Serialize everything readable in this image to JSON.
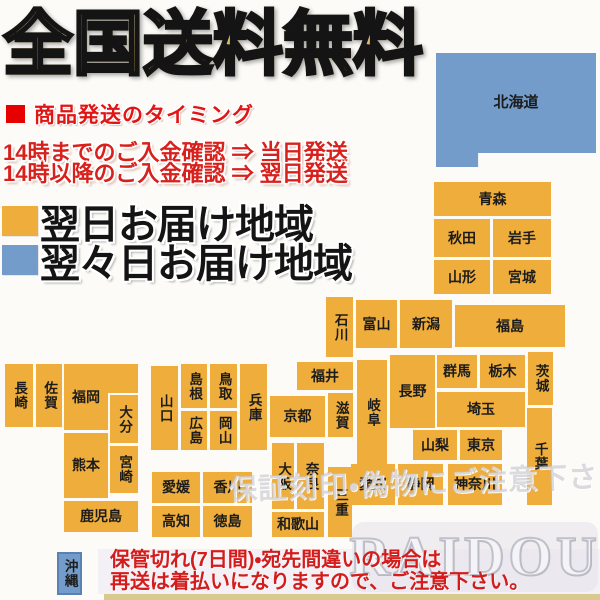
{
  "header": {
    "title": "全国送料無料",
    "shipping_heading": "商品発送のタイミング",
    "timing_lines": [
      "14時までのご入金確認 ⇒ 当日発送",
      "14時以降のご入金確認 ⇒ 翌日発送"
    ],
    "legend": [
      {
        "label": "翌日お届け地域",
        "zone": "next_day"
      },
      {
        "label": "翌々日お届け地域",
        "zone": "two_day"
      }
    ]
  },
  "colors": {
    "next_day": "#efae3b",
    "two_day": "#739cca",
    "accent_red": "#d8201c",
    "title_gold": "#d2a94e",
    "notice_bg": "#f3f1f6",
    "bottom_strip": "#d8c98f"
  },
  "map": {
    "blocks": [
      {
        "id": "hokkaido",
        "label": "北海道",
        "x": 436,
        "y": 53,
        "w": 160,
        "h": 114,
        "zone": "two_day",
        "dir": "h",
        "shape": "hokkaido"
      },
      {
        "id": "aomori",
        "label": "青森",
        "x": 434,
        "y": 182,
        "w": 117,
        "h": 34,
        "zone": "next_day",
        "dir": "h"
      },
      {
        "id": "akita",
        "label": "秋田",
        "x": 434,
        "y": 219,
        "w": 56,
        "h": 38,
        "zone": "next_day",
        "dir": "h"
      },
      {
        "id": "iwate",
        "label": "岩手",
        "x": 493,
        "y": 219,
        "w": 58,
        "h": 38,
        "zone": "next_day",
        "dir": "h"
      },
      {
        "id": "yamagata",
        "label": "山形",
        "x": 434,
        "y": 260,
        "w": 56,
        "h": 34,
        "zone": "next_day",
        "dir": "h"
      },
      {
        "id": "miyagi",
        "label": "宮城",
        "x": 493,
        "y": 260,
        "w": 58,
        "h": 34,
        "zone": "next_day",
        "dir": "h"
      },
      {
        "id": "fukushima",
        "label": "福島",
        "x": 455,
        "y": 305,
        "w": 110,
        "h": 42,
        "zone": "next_day",
        "dir": "h"
      },
      {
        "id": "niigata",
        "label": "新潟",
        "x": 400,
        "y": 300,
        "w": 52,
        "h": 48,
        "zone": "next_day",
        "dir": "h"
      },
      {
        "id": "toyama",
        "label": "富山",
        "x": 356,
        "y": 300,
        "w": 41,
        "h": 48,
        "zone": "next_day",
        "dir": "h"
      },
      {
        "id": "ishikawa",
        "label": "石川",
        "x": 326,
        "y": 297,
        "w": 27,
        "h": 60,
        "zone": "next_day",
        "dir": "v"
      },
      {
        "id": "fukui",
        "label": "福井",
        "x": 297,
        "y": 362,
        "w": 56,
        "h": 28,
        "zone": "next_day",
        "dir": "h"
      },
      {
        "id": "gifu",
        "label": "岐阜",
        "x": 357,
        "y": 360,
        "w": 30,
        "h": 105,
        "zone": "next_day",
        "dir": "v"
      },
      {
        "id": "nagano",
        "label": "長野",
        "x": 390,
        "y": 355,
        "w": 45,
        "h": 73,
        "zone": "next_day",
        "dir": "h"
      },
      {
        "id": "gunma",
        "label": "群馬",
        "x": 437,
        "y": 355,
        "w": 40,
        "h": 33,
        "zone": "next_day",
        "dir": "h"
      },
      {
        "id": "tochigi",
        "label": "栃木",
        "x": 480,
        "y": 355,
        "w": 45,
        "h": 33,
        "zone": "next_day",
        "dir": "h"
      },
      {
        "id": "ibaraki",
        "label": "茨城",
        "x": 528,
        "y": 352,
        "w": 25,
        "h": 53,
        "zone": "next_day",
        "dir": "v"
      },
      {
        "id": "saitama",
        "label": "埼玉",
        "x": 437,
        "y": 392,
        "w": 88,
        "h": 35,
        "zone": "next_day",
        "dir": "h"
      },
      {
        "id": "yamanashi",
        "label": "山梨",
        "x": 413,
        "y": 430,
        "w": 44,
        "h": 30,
        "zone": "next_day",
        "dir": "h"
      },
      {
        "id": "tokyo",
        "label": "東京",
        "x": 460,
        "y": 430,
        "w": 42,
        "h": 30,
        "zone": "next_day",
        "dir": "h"
      },
      {
        "id": "chiba",
        "label": "千葉",
        "x": 527,
        "y": 408,
        "w": 25,
        "h": 97,
        "zone": "next_day",
        "dir": "v"
      },
      {
        "id": "kanagawa",
        "label": "神奈川",
        "x": 448,
        "y": 464,
        "w": 54,
        "h": 41,
        "zone": "next_day",
        "dir": "h"
      },
      {
        "id": "shizuoka",
        "label": "静岡",
        "x": 398,
        "y": 464,
        "w": 45,
        "h": 41,
        "zone": "next_day",
        "dir": "h"
      },
      {
        "id": "aichi",
        "label": "愛知",
        "x": 351,
        "y": 464,
        "w": 44,
        "h": 41,
        "zone": "next_day",
        "dir": "h"
      },
      {
        "id": "kyoto",
        "label": "京都",
        "x": 270,
        "y": 396,
        "w": 55,
        "h": 41,
        "zone": "next_day",
        "dir": "h"
      },
      {
        "id": "shiga",
        "label": "滋賀",
        "x": 328,
        "y": 393,
        "w": 25,
        "h": 44,
        "zone": "next_day",
        "dir": "v"
      },
      {
        "id": "osaka",
        "label": "大阪",
        "x": 272,
        "y": 443,
        "w": 22,
        "h": 66,
        "zone": "next_day",
        "dir": "v"
      },
      {
        "id": "nara",
        "label": "奈良",
        "x": 297,
        "y": 443,
        "w": 27,
        "h": 66,
        "zone": "next_day",
        "dir": "v"
      },
      {
        "id": "mie",
        "label": "三重",
        "x": 328,
        "y": 467,
        "w": 24,
        "h": 70,
        "zone": "next_day",
        "dir": "v"
      },
      {
        "id": "wakayama",
        "label": "和歌山",
        "x": 272,
        "y": 512,
        "w": 52,
        "h": 25,
        "zone": "next_day",
        "dir": "h"
      },
      {
        "id": "hyogo",
        "label": "兵庫",
        "x": 240,
        "y": 364,
        "w": 27,
        "h": 86,
        "zone": "next_day",
        "dir": "v"
      },
      {
        "id": "tottori",
        "label": "鳥取",
        "x": 210,
        "y": 364,
        "w": 27,
        "h": 44,
        "zone": "next_day",
        "dir": "v"
      },
      {
        "id": "shimane",
        "label": "島根",
        "x": 181,
        "y": 364,
        "w": 26,
        "h": 44,
        "zone": "next_day",
        "dir": "v"
      },
      {
        "id": "okayama",
        "label": "岡山",
        "x": 210,
        "y": 411,
        "w": 27,
        "h": 39,
        "zone": "next_day",
        "dir": "v"
      },
      {
        "id": "hiroshima",
        "label": "広島",
        "x": 181,
        "y": 411,
        "w": 26,
        "h": 39,
        "zone": "next_day",
        "dir": "v"
      },
      {
        "id": "yamaguchi",
        "label": "山口",
        "x": 151,
        "y": 366,
        "w": 27,
        "h": 84,
        "zone": "next_day",
        "dir": "v"
      },
      {
        "id": "kagawa",
        "label": "香川",
        "x": 203,
        "y": 472,
        "w": 49,
        "h": 31,
        "zone": "next_day",
        "dir": "h"
      },
      {
        "id": "ehime",
        "label": "愛媛",
        "x": 152,
        "y": 472,
        "w": 48,
        "h": 31,
        "zone": "next_day",
        "dir": "h"
      },
      {
        "id": "tokushima",
        "label": "徳島",
        "x": 203,
        "y": 506,
        "w": 49,
        "h": 31,
        "zone": "next_day",
        "dir": "h"
      },
      {
        "id": "kochi",
        "label": "高知",
        "x": 152,
        "y": 506,
        "w": 48,
        "h": 31,
        "zone": "next_day",
        "dir": "h"
      },
      {
        "id": "fukuoka",
        "label": "福岡",
        "x": 64,
        "y": 364,
        "w": 44,
        "h": 66,
        "zone": "next_day",
        "dir": "h"
      },
      {
        "id": "fukuoka-ext",
        "label": "",
        "x": 106,
        "y": 364,
        "w": 32,
        "h": 29,
        "zone": "next_day",
        "dir": "h"
      },
      {
        "id": "saga",
        "label": "佐賀",
        "x": 36,
        "y": 364,
        "w": 26,
        "h": 63,
        "zone": "next_day",
        "dir": "v"
      },
      {
        "id": "nagasaki",
        "label": "長崎",
        "x": 5,
        "y": 364,
        "w": 28,
        "h": 63,
        "zone": "next_day",
        "dir": "v"
      },
      {
        "id": "oita",
        "label": "大分",
        "x": 110,
        "y": 395,
        "w": 28,
        "h": 48,
        "zone": "next_day",
        "dir": "v"
      },
      {
        "id": "kumamoto",
        "label": "熊本",
        "x": 64,
        "y": 433,
        "w": 44,
        "h": 65,
        "zone": "next_day",
        "dir": "h"
      },
      {
        "id": "miyazaki",
        "label": "宮崎",
        "x": 110,
        "y": 446,
        "w": 28,
        "h": 47,
        "zone": "next_day",
        "dir": "v"
      },
      {
        "id": "kagoshima",
        "label": "鹿児島",
        "x": 64,
        "y": 501,
        "w": 74,
        "h": 31,
        "zone": "next_day",
        "dir": "h"
      },
      {
        "id": "okinawa",
        "label": "沖縄",
        "x": 57,
        "y": 552,
        "w": 25,
        "h": 43,
        "zone": "two_day",
        "dir": "v",
        "shape": "okinawa"
      }
    ]
  },
  "watermark": {
    "line": "保証刻印・偽物にご注意下さい",
    "brand": "RAIDOU"
  },
  "footer": {
    "notice_lines": [
      "保管切れ(7日間)・宛先間違いの場合は",
      "再送は着払いになりますので、ご注意下さい。"
    ]
  }
}
